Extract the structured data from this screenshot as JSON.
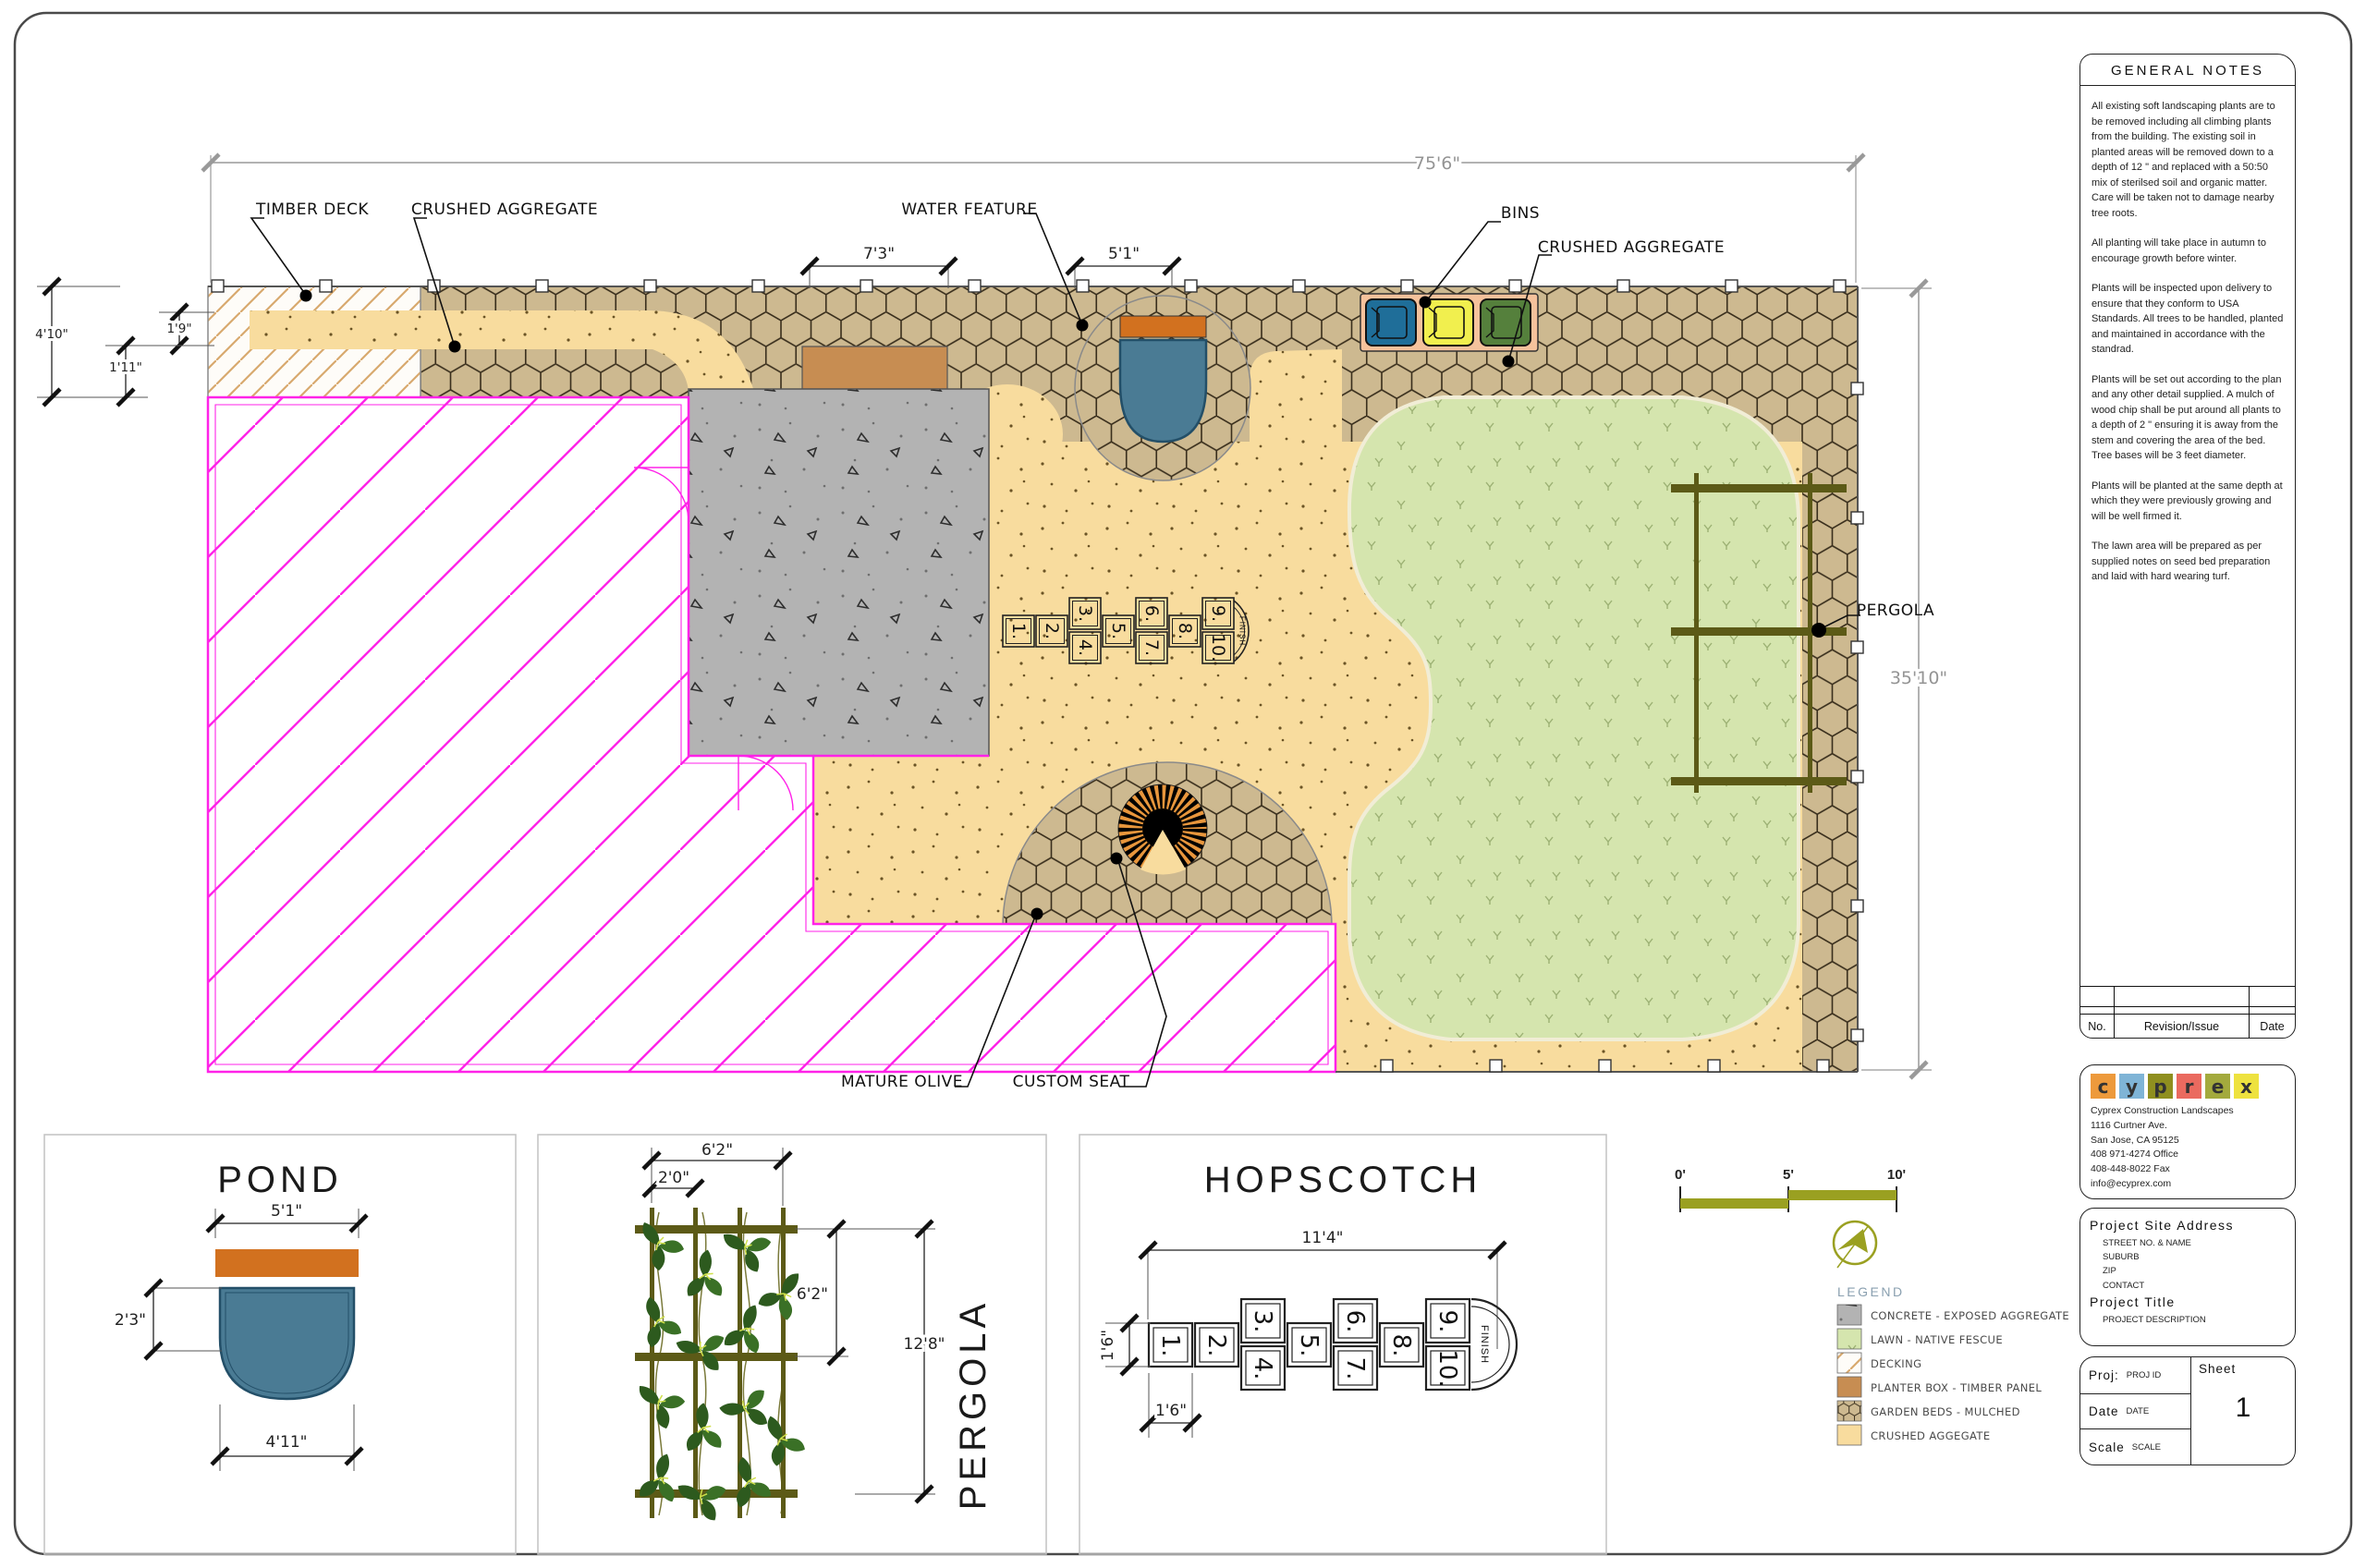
{
  "colors": {
    "building_outline": "#ff22e8",
    "mulch": "#cdb990",
    "crushed_aggregate": "#f8dc9e",
    "concrete": "#b3b3b3",
    "lawn": "#d5e5ae",
    "water": "#4a7b94",
    "planter_timber": "#c78d52",
    "pergola_timber": "#5c5a17",
    "accent_olive": "#9aa021",
    "deck_hatch": "#d8a96e"
  },
  "plan": {
    "labels": {
      "timber_deck": "TIMBER DECK",
      "crushed_aggregate_left": "CRUSHED AGGREGATE",
      "water_feature": "WATER FEATURE",
      "bins": "BINS",
      "crushed_aggregate_right": "CRUSHED AGGREGATE",
      "pergola": "PERGOLA",
      "mature_olive": "MATURE OLIVE",
      "custom_seat": "CUSTOM SEAT"
    },
    "dims": {
      "overall_width": "75'6\"",
      "planter_width": "7'3\"",
      "water_width": "5'1\"",
      "left_height": "4'10\"",
      "left_small_a": "1'9\"",
      "left_small_b": "1'11\"",
      "right_height": "35'10\""
    }
  },
  "details": {
    "pond": {
      "title": "POND",
      "dim_top": "5'1\"",
      "dim_left": "2'3\"",
      "dim_bottom": "4'11\""
    },
    "pergola": {
      "title": "PERGOLA",
      "dim_top": "6'2\"",
      "dim_bay": "2'0\"",
      "dim_mid": "6'2\"",
      "dim_total": "12'8\""
    },
    "hopscotch": {
      "title": "HOPSCOTCH",
      "dim_top": "11'4\"",
      "dim_left": "1'6\"",
      "dim_bottom": "1'6\"",
      "numbers": [
        "1.",
        "2.",
        "3.",
        "4.",
        "5.",
        "6.",
        "7.",
        "8.",
        "9.",
        "10."
      ],
      "finish": "FINISH"
    }
  },
  "scalebar": {
    "t0": "0'",
    "t5": "5'",
    "t10": "10'"
  },
  "legend": {
    "title": "LEGEND",
    "items": [
      {
        "label": "CONCRETE - EXPOSED AGGREGATE"
      },
      {
        "label": "LAWN - NATIVE FESCUE"
      },
      {
        "label": "DECKING"
      },
      {
        "label": "PLANTER  BOX - TIMBER PANEL"
      },
      {
        "label": "GARDEN BEDS - MULCHED"
      },
      {
        "label": "CRUSHED AGGEGATE"
      }
    ]
  },
  "notes": {
    "title": "GENERAL  NOTES",
    "paragraphs": [
      "All existing soft landscaping plants are to be removed including all climbing plants from the building. The existing soil in planted areas will be removed down to a depth of 12 \" and replaced with a 50:50 mix of sterilsed soil and organic matter. Care will be taken not to damage nearby tree roots.",
      "All planting will take place in autumn to encourage growth before winter.",
      "Plants will be inspected upon delivery to ensure that they conform to  USA Standards. All trees to be handled, planted and maintained in accordance with the standrad.",
      "Plants will be set out according to the plan and any other detail supplied. A mulch of wood chip shall be put around all plants to a depth of 2 \" ensuring it is away from the stem and covering the area of the bed. Tree bases will be 3 feet diameter.",
      "Plants will be planted at the same depth at which they were previously growing and will be well firmed it.",
      "The lawn area will be prepared as per supplied notes on seed bed preparation and laid with hard wearing turf."
    ]
  },
  "revision_table": {
    "no": "No.",
    "revision": "Revision/Issue",
    "date": "Date"
  },
  "company": {
    "logo": [
      {
        "ch": "c",
        "style": "background:#ed9a3c"
      },
      {
        "ch": "y",
        "style": "background:#7fb4d6"
      },
      {
        "ch": "p",
        "style": "background:#8f8f1f"
      },
      {
        "ch": "r",
        "style": "background:#ea6a5f"
      },
      {
        "ch": "e",
        "style": "background:#a3aa3d"
      },
      {
        "ch": "x",
        "style": "background:#eee23f"
      }
    ],
    "name": "Cyprex Construction Landscapes",
    "address1": "1116 Curtner Ave.",
    "address2": "San Jose, CA 95125",
    "phone": "408 971-4274 Office",
    "fax": "408-448-8022 Fax",
    "email": "info@ecyprex.com"
  },
  "project": {
    "site_address_title": "Project  Site  Address",
    "site_lines": [
      "STREET NO. & NAME",
      "SUBURB",
      "ZIP",
      "CONTACT"
    ],
    "title_label": "Project  Title",
    "description": "PROJECT DESCRIPTION",
    "proj_label": "Proj:",
    "proj_value": "PROJ ID",
    "date_label": "Date",
    "date_value": "DATE",
    "scale_label": "Scale",
    "scale_value": "SCALE",
    "sheet_label": "Sheet",
    "sheet_number": "1"
  }
}
